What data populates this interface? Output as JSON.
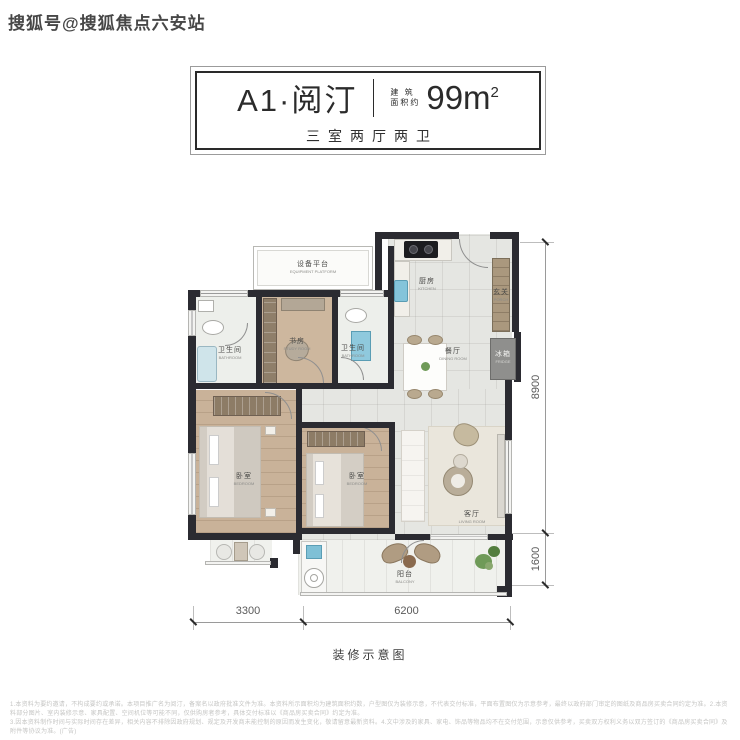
{
  "watermark": "搜狐号@搜狐焦点六安站",
  "title_card": {
    "unit_name": "A1·阅汀",
    "area_label_line1": "建 筑",
    "area_label_line2": "面积约",
    "area_value": "99m",
    "area_superscript": "2",
    "layout_subtitle": "三室两厅两卫"
  },
  "rooms": {
    "equipment_platform": {
      "zh": "设备平台",
      "en": "EQUIPMENT PLATFORM"
    },
    "bathroom_left": {
      "zh": "卫生间",
      "en": "BATHROOM"
    },
    "study": {
      "zh": "书房",
      "en": "STUDY ROOM"
    },
    "bathroom_mid": {
      "zh": "卫生间",
      "en": "BATHROOM"
    },
    "kitchen": {
      "zh": "厨房",
      "en": "KITCHEN"
    },
    "porch": {
      "zh": "玄关",
      "en": "PORCH"
    },
    "fridge": {
      "zh": "冰箱",
      "en": "FRIDGE"
    },
    "dining": {
      "zh": "餐厅",
      "en": "DINING ROOM"
    },
    "bedroom_left": {
      "zh": "卧室",
      "en": "BEDROOM"
    },
    "bedroom_mid": {
      "zh": "卧室",
      "en": "BEDROOM"
    },
    "living": {
      "zh": "客厅",
      "en": "LIVING ROOM"
    },
    "balcony": {
      "zh": "阳台",
      "en": "BALCONY"
    }
  },
  "dimensions": {
    "right_upper": "8900",
    "right_lower": "1600",
    "bottom_left": "3300",
    "bottom_right": "6200"
  },
  "caption": "装修示意图",
  "footer": {
    "line1": "1.本资料为要约邀请，不构成要约或承诺。本项目推广名为阅汀，备案名以政府批准文件为准。本资料所示面积均为建筑面积约数，户型图仅为装修示意，不代表交付标准，平面布置图仅为示意参考，最终以政府部门审定的图纸及商品房买卖合同约定为准。2.本资料部分图片、室内装修示意、家具配置、空间机位等可能不同，仅供购房者参考，具体交付标准以《商品房买卖合同》约定为准。",
    "line2": "3.因本资料制作时间与实际时间存在差异，相关内容不排除因政府规划、规定及开发商未能控制的原因而发生变化，敬请留意最新资料。4.文中涉及的家具、家电、饰品等物品均不在交付范围，示意仅供参考，买卖双方权利义务以双方签订的《商品房买卖合同》及附件等协议为准。(广告)"
  },
  "colors": {
    "wall": "#2b2b31",
    "wood_floor": "#c9b299",
    "tile_floor": "#e5e6e2",
    "fixture_blue": "#84c4da",
    "plant_green": "#6f9a58",
    "dimension_line": "#9a9a9a"
  }
}
